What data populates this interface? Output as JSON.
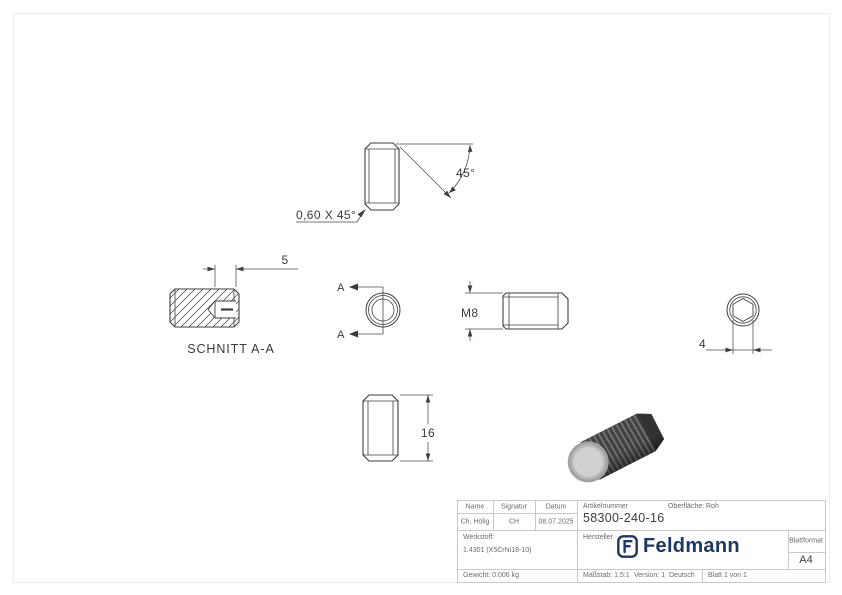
{
  "page": {
    "background": "#ffffff",
    "frame_color": "#ececec"
  },
  "drawing": {
    "line_color": "#3f3f3f",
    "labels": {
      "chamfer_note": "0,60 X 45°",
      "angle": "45°",
      "socket_depth": "5",
      "section_title": "SCHNITT A-A",
      "section_marker": "A",
      "thread": "M8",
      "hex_width": "4",
      "length": "16"
    }
  },
  "title_block": {
    "border_color": "#c9c9c9",
    "header": {
      "name_label": "Name",
      "signature_label": "Signatur",
      "date_label": "Datum",
      "name_value": "Ch. Hölig",
      "signature_value": "CH",
      "date_value": "08.07.2025",
      "article_label": "Artikelnummer",
      "article_value": "58300-240-16",
      "surface_label": "Oberfläche:",
      "surface_value": "Roh"
    },
    "material": {
      "label": "Werkstoff:",
      "value": "1.4301 (X5CrNi18-10)"
    },
    "manufacturer": {
      "label": "Hersteller",
      "brand": "Feldmann",
      "brand_color": "#1c3766"
    },
    "sheet_format": {
      "label": "Blattformat",
      "value": "A4"
    },
    "footer": {
      "weight": "Gewicht: 0.006 kg",
      "scale": "Maßstab: 1,5:1",
      "version": "Version: 1",
      "language": "Deutsch",
      "sheet": "Blatt 1 von 1"
    }
  }
}
